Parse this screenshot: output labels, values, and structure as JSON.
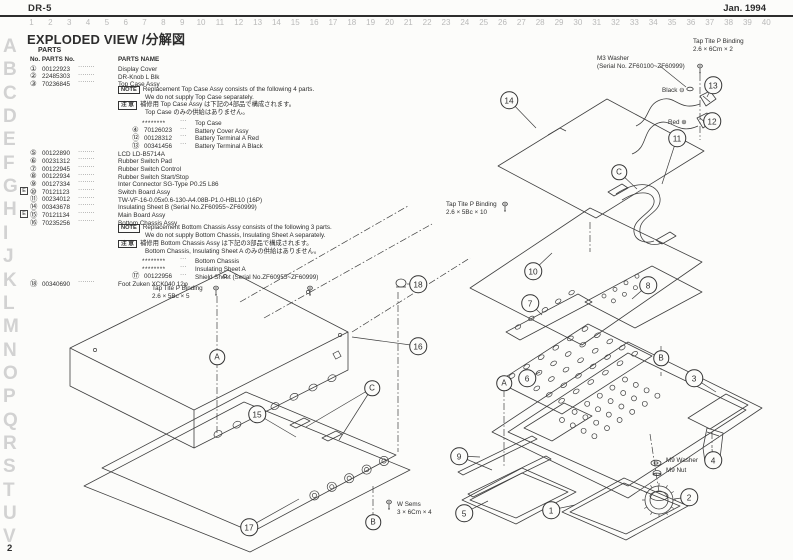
{
  "page": {
    "doc_id": "DR-5",
    "date": "Jan. 1994",
    "page_number": "2",
    "title": "EXPLODED VIEW /分解図",
    "line_color": "#3f3f3f",
    "muted_color": "#d2d2d2"
  },
  "grid": {
    "columns": [
      "1",
      "2",
      "3",
      "4",
      "5",
      "6",
      "7",
      "8",
      "9",
      "10",
      "11",
      "12",
      "13",
      "14",
      "15",
      "16",
      "17",
      "18",
      "19",
      "20",
      "21",
      "22",
      "23",
      "24",
      "25",
      "26",
      "27",
      "28",
      "29",
      "30",
      "31",
      "32",
      "33",
      "34",
      "35",
      "36",
      "37",
      "38",
      "39",
      "40"
    ],
    "rows": [
      "A",
      "B",
      "C",
      "D",
      "E",
      "F",
      "G",
      "H",
      "I",
      "J",
      "K",
      "L",
      "M",
      "N",
      "O",
      "P",
      "Q",
      "R",
      "S",
      "T",
      "U",
      "V"
    ]
  },
  "parts_list": {
    "label": "PARTS",
    "col1": "No. PARTS No.",
    "col2": "PARTS NAME",
    "star": "********",
    "dots_item": "········",
    "dots_sub": "···",
    "lines": [
      {
        "k": "item",
        "n": "①",
        "pn": "00122923",
        "name": "Display Cover"
      },
      {
        "k": "item",
        "n": "②",
        "pn": "22485303",
        "name": "DR-Knob L Blk"
      },
      {
        "k": "item",
        "n": "③",
        "pn": "70236845",
        "name": "Top Case Assy"
      },
      {
        "k": "note",
        "box": "NOTE",
        "t": "Replacement Top Case Assy consists of the following 4 parts."
      },
      {
        "k": "cont",
        "t": "We do not supply Top Case separately."
      },
      {
        "k": "note",
        "box": "注 意",
        "t": "補修用 Top Case Assy は下記の4部品で構成されます。"
      },
      {
        "k": "cont",
        "t": "Top Case のみの供給はありません。"
      },
      {
        "k": "sub",
        "star": true,
        "t": "Top Case"
      },
      {
        "k": "sub",
        "n": "④",
        "pn": "70126023",
        "t": "Battery Cover Assy"
      },
      {
        "k": "sub",
        "n": "⑫",
        "pn": "00128312",
        "t": "Battery Terminal A Red"
      },
      {
        "k": "sub",
        "n": "⑬",
        "pn": "00341456",
        "t": "Battery Terminal A Black"
      },
      {
        "k": "item",
        "n": "⑤",
        "pn": "00122890",
        "name": "LCD LD-B5714A"
      },
      {
        "k": "item",
        "n": "⑥",
        "pn": "00231312",
        "name": "Rubber Switch Pad"
      },
      {
        "k": "item",
        "n": "⑦",
        "pn": "00122945",
        "name": "Rubber Switch Control"
      },
      {
        "k": "item",
        "n": "⑧",
        "pn": "00122934",
        "name": "Rubber Switch Start/Stop"
      },
      {
        "k": "item",
        "n": "⑨",
        "pn": "00127334",
        "name": "Inter Connector SG-Type P0.25 L86"
      },
      {
        "k": "item",
        "badge": "E",
        "n": "⑩",
        "pn": "70121123",
        "name": "Switch Board Assy"
      },
      {
        "k": "item",
        "n": "⑪",
        "pn": "00234012",
        "name": "TW-VF-16-0.05x0.6-130-A4.08B-P1.0-HBL10 (16P)"
      },
      {
        "k": "item",
        "n": "⑭",
        "pn": "00343678",
        "name": "Insulating Sheet B (Serial No.ZF60955~ZF60999)"
      },
      {
        "k": "item",
        "badge": "E",
        "n": "⑮",
        "pn": "70121134",
        "name": "Main Board Assy"
      },
      {
        "k": "item",
        "n": "⑯",
        "pn": "70235256",
        "name": "Bottom Chassis Assy"
      },
      {
        "k": "note",
        "box": "NOTE",
        "t": "Replacement Bottom Chassis Assy consists of the following 3 parts."
      },
      {
        "k": "cont",
        "t": "We do not supply Bottom Chassis, Insulating Sheet A separately."
      },
      {
        "k": "note",
        "box": "注 意",
        "t": "補修用 Bottom Chassis Assy は下記の3部品で構成されます。"
      },
      {
        "k": "cont",
        "t": "Bottom Chassis, Insulating Sheet A のみの供給はありません。"
      },
      {
        "k": "sub",
        "star": true,
        "t": "Bottom Chassis"
      },
      {
        "k": "sub",
        "star": true,
        "t": "Insulating Sheet A"
      },
      {
        "k": "sub",
        "n": "⑰",
        "pn": "00122956",
        "t": "Shield Sheet (Serial No.ZF60955~ZF60999)"
      },
      {
        "k": "item",
        "n": "⑱",
        "pn": "00340690",
        "name": "Foot Zuken XCK040 12φ"
      }
    ]
  },
  "diagram": {
    "callouts": [
      {
        "l": "1",
        "x": 551,
        "y": 510,
        "t": [
          [
            575,
            505
          ]
        ]
      },
      {
        "l": "2",
        "x": 689,
        "y": 497,
        "t": [
          [
            674,
            499
          ]
        ]
      },
      {
        "l": "3",
        "x": 694,
        "y": 378,
        "t": [
          [
            716,
            392
          ]
        ]
      },
      {
        "l": "4",
        "x": 713,
        "y": 460,
        "t": [
          [
            712,
            449
          ]
        ]
      },
      {
        "l": "5",
        "x": 464,
        "y": 513,
        "t": [
          [
            488,
            501
          ]
        ]
      },
      {
        "l": "6",
        "x": 527,
        "y": 378,
        "t": [
          [
            540,
            372
          ]
        ]
      },
      {
        "l": "7",
        "x": 530,
        "y": 303,
        "t": [
          [
            542,
            315
          ]
        ]
      },
      {
        "l": "8",
        "x": 648,
        "y": 285,
        "t": [
          [
            632,
            299
          ]
        ]
      },
      {
        "l": "9",
        "x": 459,
        "y": 456,
        "t": [
          [
            480,
            457
          ],
          [
            492,
            470
          ]
        ]
      },
      {
        "l": "10",
        "x": 533,
        "y": 271,
        "t": [
          [
            552,
            253
          ]
        ]
      },
      {
        "l": "11",
        "x": 677,
        "y": 138,
        "t": [
          [
            662,
            184
          ]
        ]
      },
      {
        "l": "12",
        "x": 712,
        "y": 121,
        "t": [
          [
            703,
            122
          ]
        ]
      },
      {
        "l": "13",
        "x": 713,
        "y": 85,
        "t": [
          [
            707,
            97
          ]
        ]
      },
      {
        "l": "14",
        "x": 509,
        "y": 100,
        "t": [
          [
            536,
            128
          ]
        ]
      },
      {
        "l": "15",
        "x": 257,
        "y": 414,
        "t": [
          [
            296,
            437
          ]
        ]
      },
      {
        "l": "16",
        "x": 418,
        "y": 346,
        "t": [
          [
            352,
            337
          ]
        ]
      },
      {
        "l": "17",
        "x": 249,
        "y": 527,
        "t": [
          [
            299,
            499
          ]
        ]
      },
      {
        "l": "18",
        "x": 418,
        "y": 284,
        "t": [
          [
            407,
            284
          ]
        ]
      },
      {
        "l": "A",
        "x": 217,
        "y": 357,
        "t": []
      },
      {
        "l": "B",
        "x": 373,
        "y": 522,
        "t": []
      },
      {
        "l": "C",
        "x": 372,
        "y": 388,
        "t": [
          [
            306,
            427
          ],
          [
            339,
            440
          ]
        ]
      },
      {
        "l": "A",
        "x": 504,
        "y": 383,
        "t": []
      },
      {
        "l": "B",
        "x": 661,
        "y": 358,
        "t": []
      },
      {
        "l": "C",
        "x": 619,
        "y": 172,
        "t": [
          [
            637,
            189
          ]
        ]
      }
    ],
    "labels": [
      {
        "x": 693,
        "y": 38,
        "lines": [
          "Tap Tite P Binding",
          "2.6 × 6Cm × 2"
        ]
      },
      {
        "x": 597,
        "y": 55,
        "lines": [
          "M3 Washer",
          "(Serial No. ZF60100~ZF60999)"
        ]
      },
      {
        "x": 662,
        "y": 87,
        "lines": [
          "Black ⊖"
        ]
      },
      {
        "x": 668,
        "y": 119,
        "lines": [
          "Red ⊕"
        ]
      },
      {
        "x": 446,
        "y": 201,
        "lines": [
          "Tap Tite P Binding",
          "2.6 × 5Bc × 10"
        ]
      },
      {
        "x": 152,
        "y": 285,
        "lines": [
          "Tap Tite P Binding",
          "2.6 × 5Bc × 5"
        ]
      },
      {
        "x": 666,
        "y": 457,
        "lines": [
          "M9 Washer"
        ]
      },
      {
        "x": 666,
        "y": 467,
        "lines": [
          "M9 Nut"
        ]
      },
      {
        "x": 397,
        "y": 501,
        "lines": [
          "W Sems",
          "3 × 6Cm × 4"
        ]
      }
    ]
  }
}
